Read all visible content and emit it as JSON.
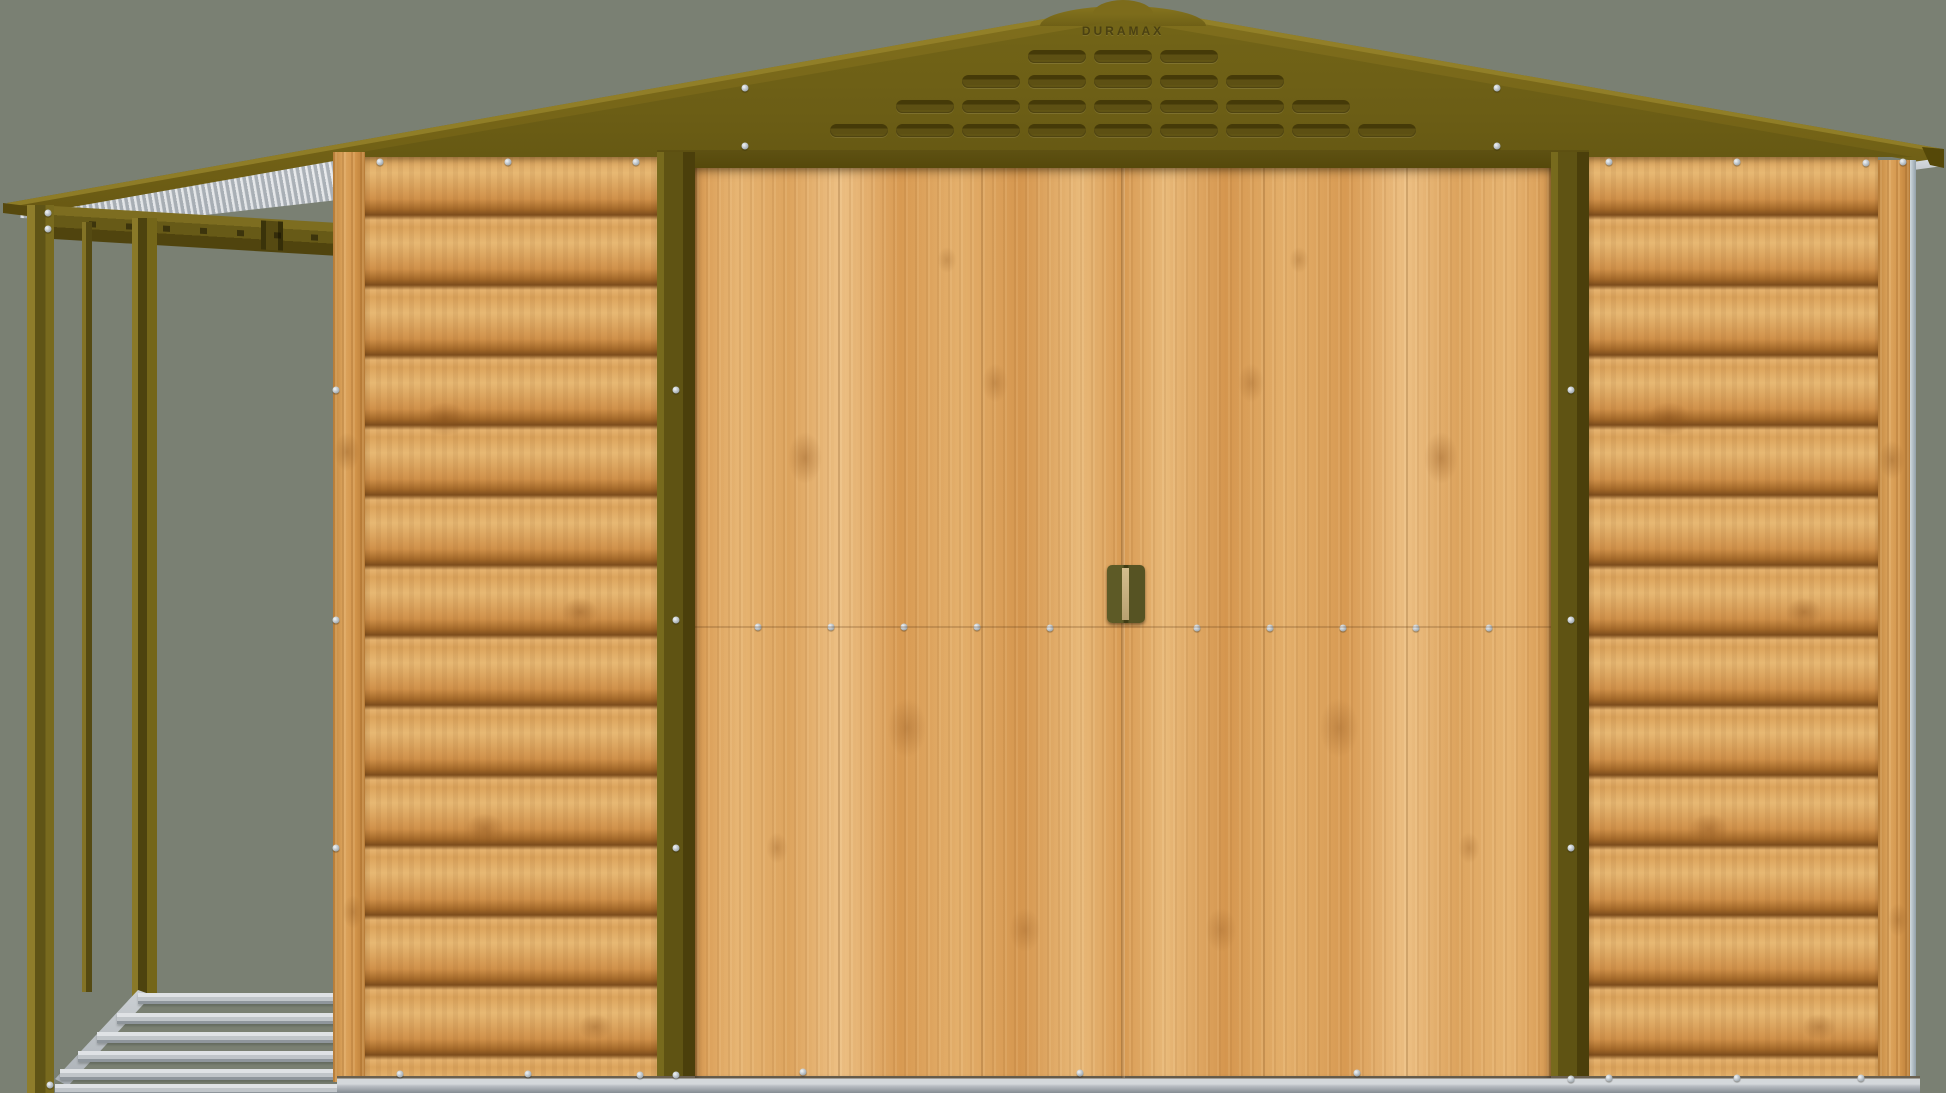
{
  "image": {
    "type": "product-render",
    "subject": "Metal apex garden shed with wood-effect cladding, olive green roof and trim, double sliding doors, and attached open log-store frame on the left"
  },
  "branding": {
    "roof_logo": "DURAMAX"
  },
  "colors": {
    "background": "#7a8073",
    "roof_olive": "#756417",
    "gable_olive": "#6b5d15",
    "trim_olive_dark": "#544709",
    "post_olive": "#5f5313",
    "wood_mid": "#d89a52",
    "wood_light": "#edc084",
    "wood_dark": "#7d4d1c",
    "metal_silver": "#c9ced3",
    "metal_shadow": "#858c93"
  },
  "gable": {
    "louver_rows_y": [
      50,
      75,
      100,
      124
    ],
    "louver_columns": [
      {
        "x": 830,
        "count": 1
      },
      {
        "x": 896,
        "count": 2
      },
      {
        "x": 962,
        "count": 3
      },
      {
        "x": 1028,
        "count": 4
      },
      {
        "x": 1094,
        "count": 4
      },
      {
        "x": 1160,
        "count": 4
      },
      {
        "x": 1226,
        "count": 3
      },
      {
        "x": 1292,
        "count": 2
      },
      {
        "x": 1358,
        "count": 1
      }
    ]
  },
  "rivets": [
    [
      745,
      88
    ],
    [
      745,
      146
    ],
    [
      1497,
      88
    ],
    [
      1497,
      146
    ],
    [
      380,
      162
    ],
    [
      508,
      162
    ],
    [
      636,
      162
    ],
    [
      1609,
      162
    ],
    [
      1737,
      162
    ],
    [
      1866,
      163
    ],
    [
      1903,
      162
    ],
    [
      336,
      390
    ],
    [
      336,
      620
    ],
    [
      336,
      848
    ],
    [
      676,
      390
    ],
    [
      676,
      620
    ],
    [
      676,
      848
    ],
    [
      1571,
      390
    ],
    [
      1571,
      620
    ],
    [
      1571,
      848
    ],
    [
      758,
      627
    ],
    [
      831,
      627
    ],
    [
      904,
      627
    ],
    [
      977,
      627
    ],
    [
      1050,
      628
    ],
    [
      1197,
      628
    ],
    [
      1270,
      628
    ],
    [
      1343,
      628
    ],
    [
      1416,
      628
    ],
    [
      1489,
      628
    ],
    [
      803,
      1072
    ],
    [
      1080,
      1073
    ],
    [
      1357,
      1073
    ],
    [
      400,
      1074
    ],
    [
      528,
      1074
    ],
    [
      640,
      1075
    ],
    [
      1609,
      1078
    ],
    [
      1737,
      1078
    ],
    [
      1861,
      1078
    ],
    [
      676,
      1075
    ],
    [
      1571,
      1079
    ],
    [
      50,
      1085
    ],
    [
      48,
      213
    ],
    [
      48,
      229
    ]
  ],
  "handle": {
    "screws": [
      [
        1112,
        574
      ],
      [
        1138,
        574
      ],
      [
        1112,
        617
      ],
      [
        1138,
        617
      ]
    ]
  },
  "log_store": {
    "floor_joists": [
      {
        "x": 138,
        "y": 993,
        "w": 202
      },
      {
        "x": 117,
        "y": 1013,
        "w": 223
      },
      {
        "x": 97,
        "y": 1032,
        "w": 243
      },
      {
        "x": 78,
        "y": 1051,
        "w": 262
      },
      {
        "x": 60,
        "y": 1069,
        "w": 280
      },
      {
        "x": 55,
        "y": 1084,
        "w": 285
      }
    ]
  }
}
